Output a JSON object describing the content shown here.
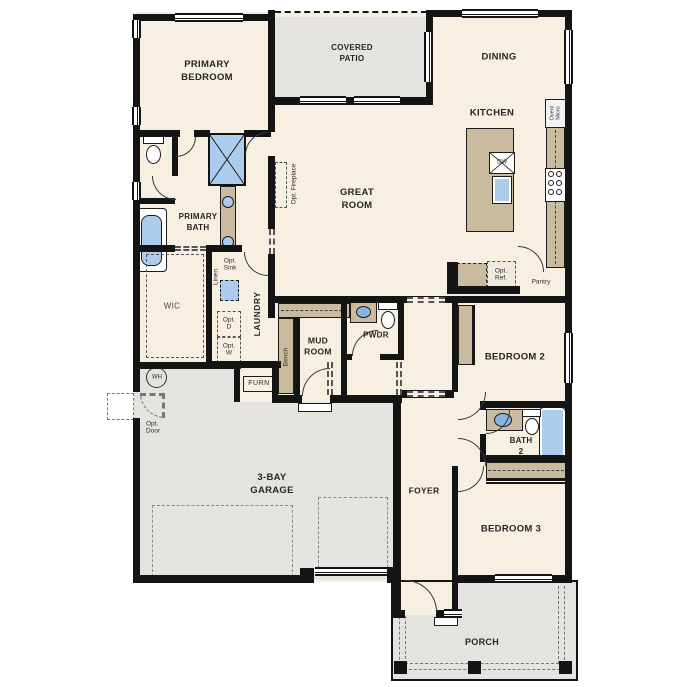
{
  "plan_type": "single-story floor plan",
  "colors": {
    "wall": "#141414",
    "floor": "#f6efe2",
    "outdoor": "#e4e3e0",
    "cabinet": "#cabb9e",
    "fixture_blue": "#abccec"
  },
  "rooms": {
    "primary_bedroom": "PRIMARY\nBEDROOM",
    "covered_patio": "COVERED\nPATIO",
    "dining": "DINING",
    "kitchen": "KITCHEN",
    "great_room": "GREAT\nROOM",
    "primary_bath": "PRIMARY\nBATH",
    "wic": "WIC",
    "laundry": "LAUNDRY",
    "mud_room": "MUD\nROOM",
    "pwdr": "PWDR",
    "bedroom2": "BEDROOM 2",
    "bath2": "BATH\n2",
    "bedroom3": "BEDROOM 3",
    "foyer": "FOYER",
    "garage": "3-BAY\nGARAGE",
    "porch": "PORCH"
  },
  "annotations": {
    "opt_fireplace": "Opt. Fireplace",
    "linen": "Linen",
    "opt_sink": "Opt.\nSink",
    "opt_d": "Opt.\nD",
    "opt_w": "Opt.\nW",
    "bench": "Bench",
    "furn": "FURN",
    "wh": "WH",
    "opt_door": "Opt.\nDoor",
    "opt_ref": "Opt.\nRef.",
    "pantry": "Pantry",
    "oven_micro": "Oven/\nMicro",
    "dw": "DW"
  }
}
